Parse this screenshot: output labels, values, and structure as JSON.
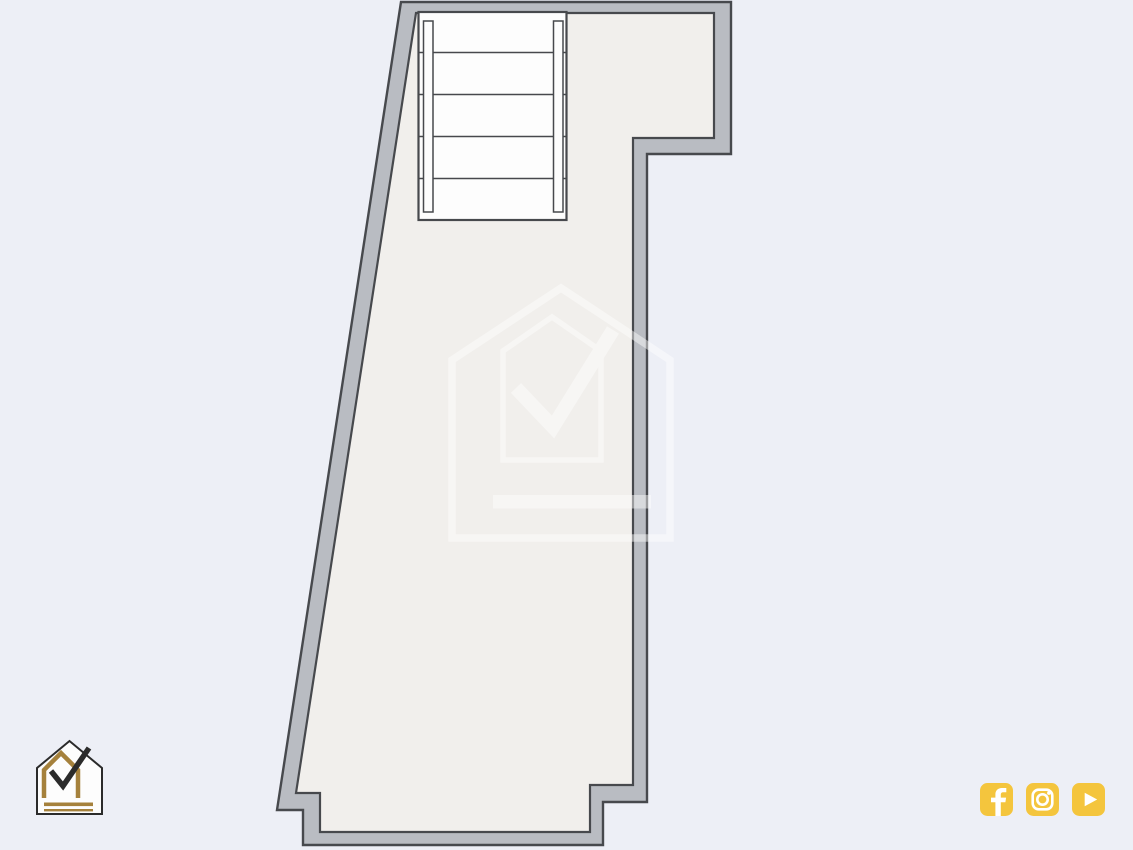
{
  "colors": {
    "background": "#edeff6",
    "floor": "#f1efec",
    "wall": "#b9bcc2",
    "outline": "#47494d",
    "stair": "#fdfdfd",
    "watermark": "#ffffff",
    "gold": "#a5813c",
    "ink": "#2b2b2b",
    "social_yellow": "#f4c53d",
    "social_glyph": "#ffffff"
  },
  "branding": {
    "logo": "house-checkmark-logo",
    "watermark": "house-checkmark-watermark"
  },
  "plan": {
    "stair_step_count": "5",
    "stair_step_lines": "4"
  },
  "social": {
    "items": [
      {
        "name": "facebook"
      },
      {
        "name": "instagram"
      },
      {
        "name": "youtube"
      }
    ]
  }
}
